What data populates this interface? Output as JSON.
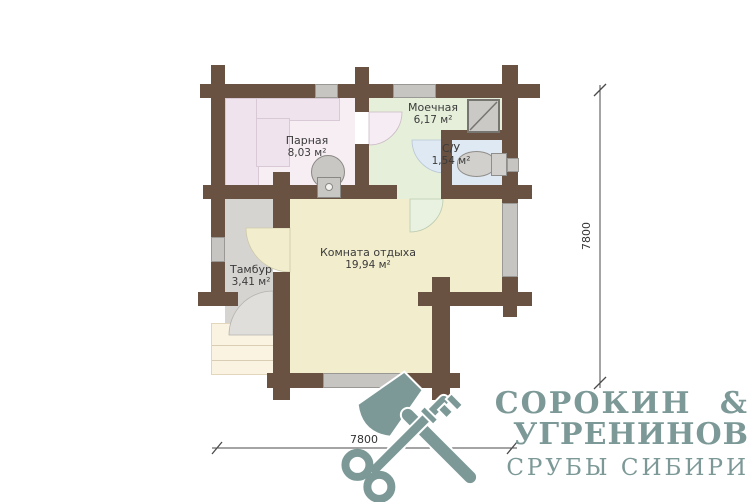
{
  "plan": {
    "title": "bath-house floor plan",
    "rooms": [
      {
        "name": "Парная",
        "area": "8,03 м²"
      },
      {
        "name": "Моечная",
        "area": "6,17 м²"
      },
      {
        "name": "С/У",
        "area": "1,54 м²"
      },
      {
        "name": "Комната отдыха",
        "area": "19,94 м²"
      },
      {
        "name": "Тамбур",
        "area": "3,41 м²"
      }
    ],
    "fixtures": [
      "stove",
      "shower-cabin",
      "toilet",
      "porch-steps"
    ],
    "colors": {
      "wall": "#6a5243",
      "parnaya": "#f7eef4",
      "moechnaya": "#e6efda",
      "su": "#dfe9f3",
      "komnata": "#f1edcd",
      "tambur": "#d6d4d1",
      "porch": "#faf3e2",
      "window": "#c7c5c2"
    }
  },
  "dimensions": {
    "width_label": "7800",
    "height_label": "7800"
  },
  "logo": {
    "line1": "СОРОКИН &",
    "line2": "УГРЕНИНОВ",
    "tagline": "СРУБЫ СИБИРИ",
    "color": "#7c9997",
    "icon": "crossed-axe-and-key"
  }
}
